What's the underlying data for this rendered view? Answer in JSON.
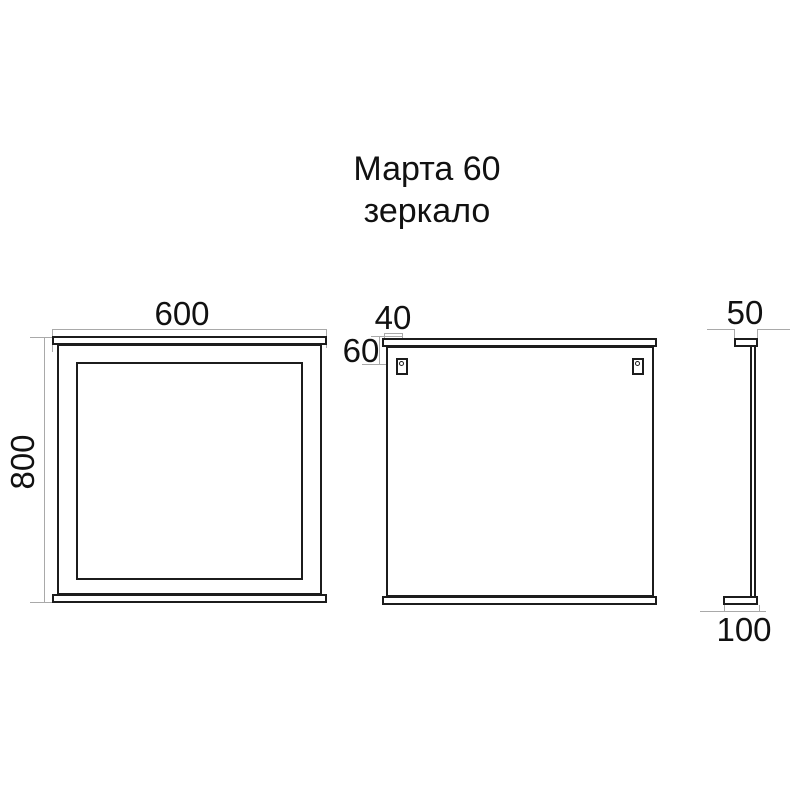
{
  "title": {
    "line1": "Марта 60",
    "line2": "зеркало"
  },
  "views": {
    "front": {
      "width_label": "600",
      "height_label": "800"
    },
    "back": {
      "hole_offset_x_label": "40",
      "hole_offset_y_label": "60"
    },
    "side": {
      "top_depth_label": "50",
      "bottom_depth_label": "100"
    }
  },
  "colors": {
    "object_line": "#1c1c1c",
    "dimension_line": "#a9a9a9",
    "text": "#111111",
    "background": "#ffffff"
  }
}
